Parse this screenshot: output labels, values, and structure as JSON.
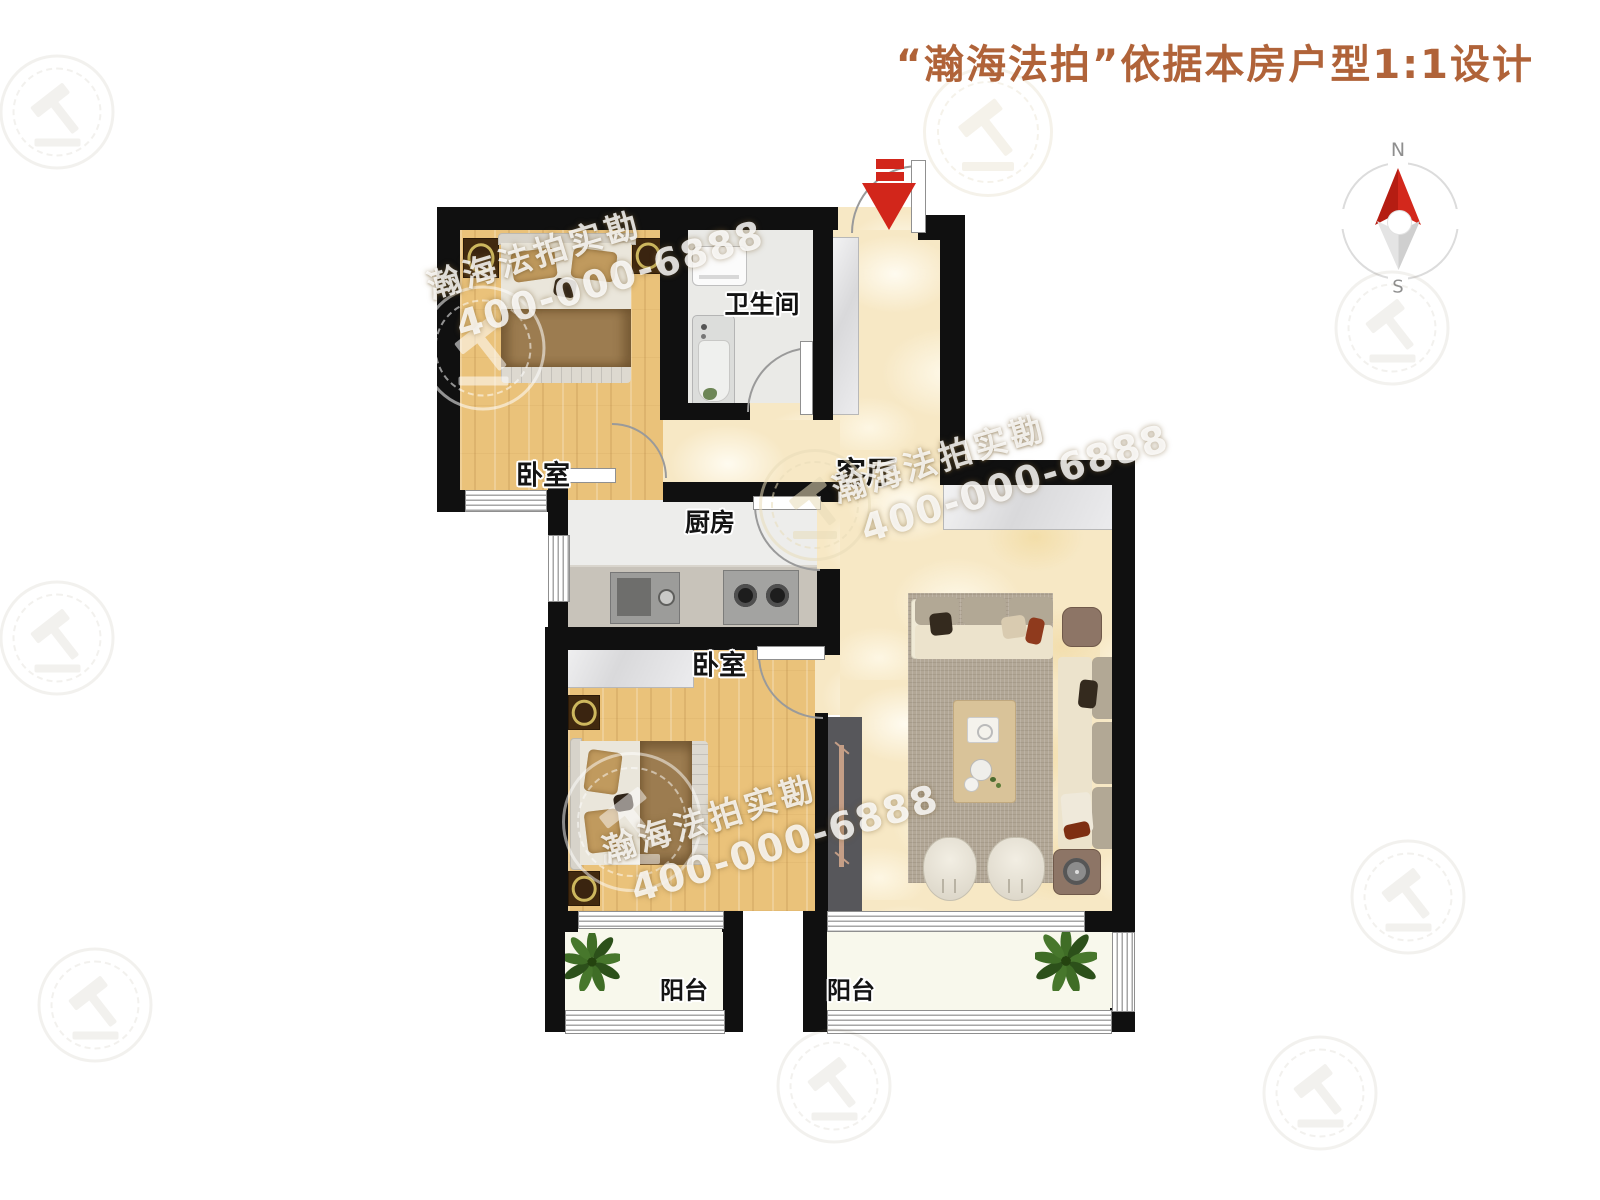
{
  "title": "“瀚海法拍”依据本房户型1:1设计",
  "compass": {
    "north": "N",
    "south": "S"
  },
  "watermark": {
    "brand": "瀚海法拍实勘",
    "phone": "400-000-6888"
  },
  "rooms": {
    "bedroom1": "卧室",
    "bathroom": "卫生间",
    "kitchen": "厨房",
    "bedroom2": "卧室",
    "living": "客厅",
    "balcony_left": "阳台",
    "balcony_right": "阳台"
  },
  "colors": {
    "title": "#b06339",
    "wall": "#101010",
    "entry_arrow": "#d2261b",
    "compass_north": "#cc2016",
    "wood_floor": "#eac27a",
    "marble_floor": "#f7e8c5"
  }
}
